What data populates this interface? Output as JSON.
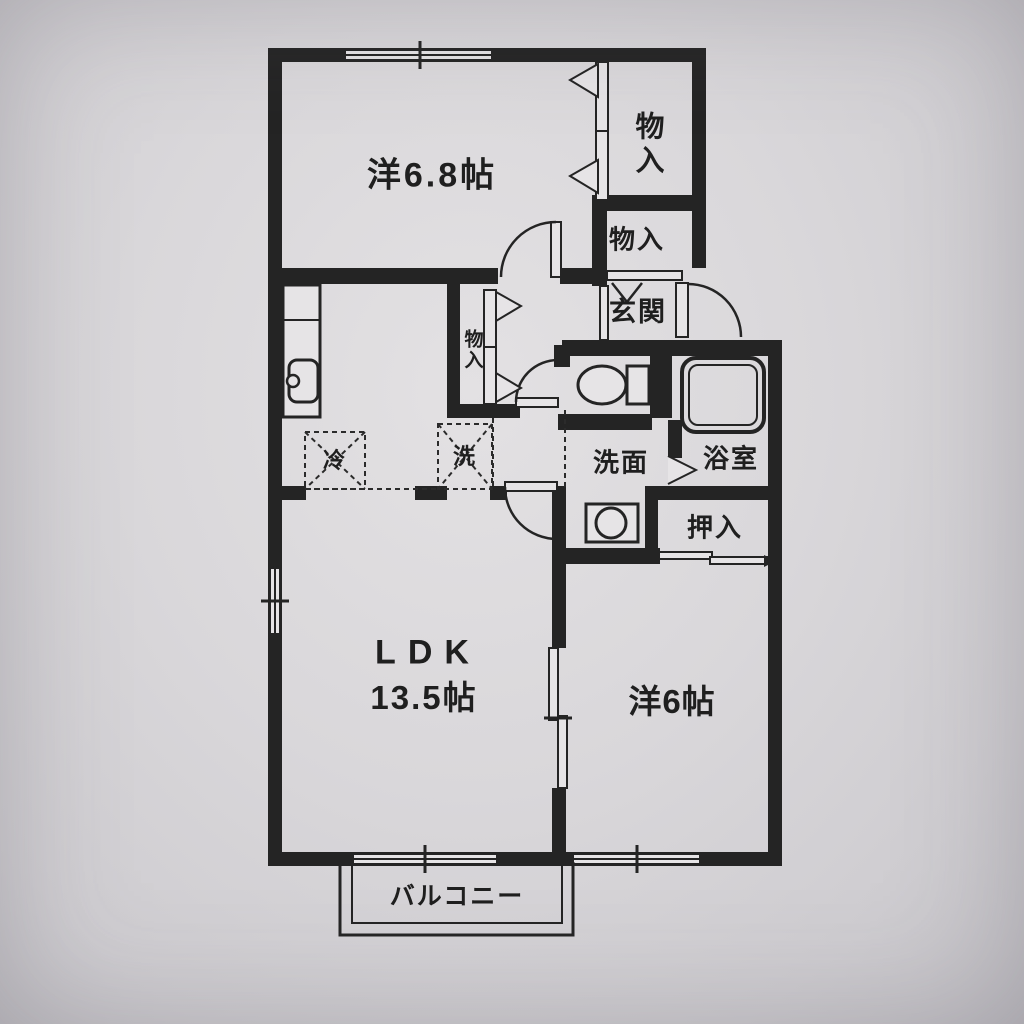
{
  "floorplan": {
    "type": "apartment-floor-plan",
    "rooms": {
      "bedroom1": {
        "label": "洋6.8帖"
      },
      "ldk": {
        "label": "LDK",
        "area": "13.5帖"
      },
      "bedroom2": {
        "label": "洋6帖"
      },
      "entrance": {
        "label": "玄関"
      },
      "washroom": {
        "label": "洗面"
      },
      "bathroom": {
        "label": "浴室"
      },
      "closet": {
        "label": "押入"
      },
      "storage_top": {
        "label": "物入"
      },
      "storage_mid": {
        "label": "物入"
      },
      "storage_hall": {
        "label": "物入"
      },
      "balcony": {
        "label": "バルコニー"
      },
      "refrigerator": {
        "label": "冷"
      },
      "washer": {
        "label": "洗"
      }
    },
    "colors": {
      "wall": "#242424",
      "paper": "#d9d7da",
      "ink": "#1f1f1f"
    }
  }
}
